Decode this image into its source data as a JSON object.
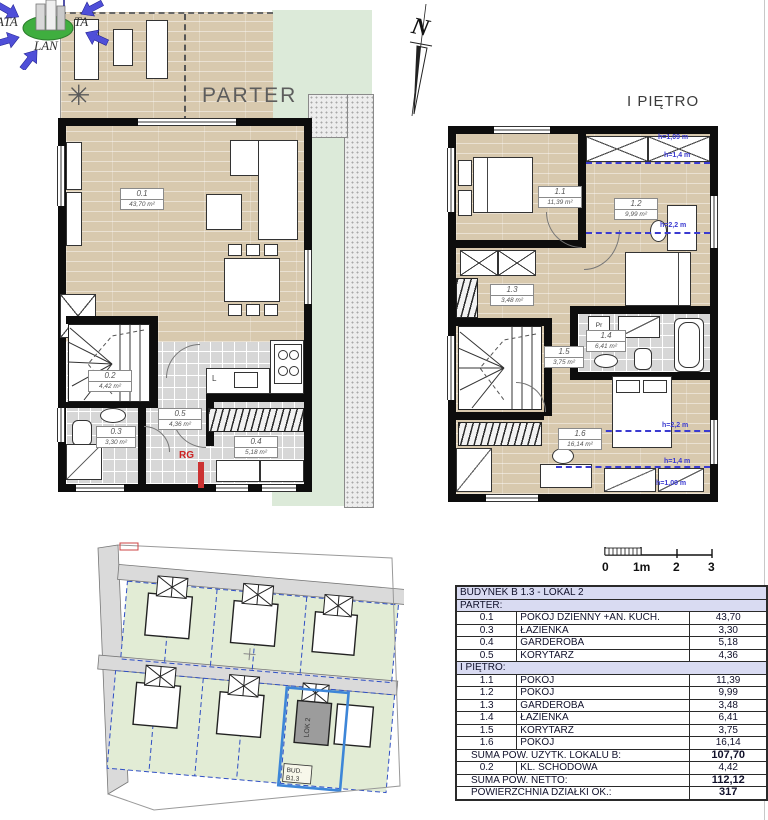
{
  "logo": {
    "ata": "ATA",
    "lan": "LAN",
    "ta": "TA"
  },
  "north_letter": "N",
  "parter": {
    "title": "PARTER",
    "rooms": {
      "r01": {
        "id": "0.1",
        "area": "43,70 m²"
      },
      "r02": {
        "id": "0.2",
        "area": "4,42 m²"
      },
      "r03": {
        "id": "0.3",
        "area": "3,30 m²"
      },
      "r04": {
        "id": "0.4",
        "area": "5,18 m²"
      },
      "r05": {
        "id": "0.5",
        "area": "4,36 m²"
      }
    },
    "rg_label": "RG",
    "fridge_label": "L"
  },
  "pietro": {
    "title": "I PIĘTRO",
    "rooms": {
      "r11": {
        "id": "1.1",
        "area": "11,39 m²"
      },
      "r12": {
        "id": "1.2",
        "area": "9,99 m²"
      },
      "r13": {
        "id": "1.3",
        "area": "3,48 m²"
      },
      "r14": {
        "id": "1.4",
        "area": "6,41 m²"
      },
      "r15": {
        "id": "1.5",
        "area": "3,75 m²"
      },
      "r16": {
        "id": "1.6",
        "area": "16,14 m²"
      }
    },
    "washer_label": "Pr",
    "heights": {
      "h109": "h=1,09 m",
      "h14": "h=1,4 m",
      "h22": "h=2,2 m"
    }
  },
  "site_plan": {
    "building_label": "LOK 2",
    "plot_label_line1": "BUD.",
    "plot_label_line2": "B1.3"
  },
  "scale_bar": {
    "t0": "0",
    "t1": "1m",
    "t2": "2",
    "t3": "3"
  },
  "table": {
    "title": "BUDYNEK B 1.3 - LOKAL 2",
    "parter_header": "PARTER:",
    "parter_rows": [
      {
        "no": "0.1",
        "name": "POKÓJ DZIENNY +AN. KUCH.",
        "area": "43,70"
      },
      {
        "no": "0.3",
        "name": "ŁAZIENKA",
        "area": "3,30"
      },
      {
        "no": "0.4",
        "name": "GARDEROBA",
        "area": "5,18"
      },
      {
        "no": "0.5",
        "name": "KORYTARZ",
        "area": "4,36"
      }
    ],
    "pietro_header": "I PIĘTRO:",
    "pietro_rows": [
      {
        "no": "1.1",
        "name": "POKÓJ",
        "area": "11,39"
      },
      {
        "no": "1.2",
        "name": "POKÓJ",
        "area": "9,99"
      },
      {
        "no": "1.3",
        "name": "GARDEROBA",
        "area": "3,48"
      },
      {
        "no": "1.4",
        "name": "ŁAZIENKA",
        "area": "6,41"
      },
      {
        "no": "1.5",
        "name": "KORYTARZ",
        "area": "3,75"
      },
      {
        "no": "1.6",
        "name": "POKÓJ",
        "area": "16,14"
      }
    ],
    "sum_usable": {
      "label": "SUMA POW. UŻYTK. LOKALU B:",
      "value": "107,70"
    },
    "staircase_row": {
      "no": "0.2",
      "name": "KL. SCHODOWA",
      "area": "4,42"
    },
    "sum_netto": {
      "label": "SUMA POW. NETTO:",
      "value": "112,12"
    },
    "plot_area": {
      "label": "POWIERZCHNIA DZIAŁKI OK.:",
      "value": "317"
    }
  },
  "colors": {
    "wood": "#d8c9ae",
    "tile": "#d7d7d7",
    "garden_green": "#dcead9",
    "wall": "#0d0d0d",
    "annotation_blue": "#3a3ad0",
    "table_header": "#d9dbf2",
    "highlight_blue": "#3d86d8",
    "rg_red": "#cc2222"
  }
}
